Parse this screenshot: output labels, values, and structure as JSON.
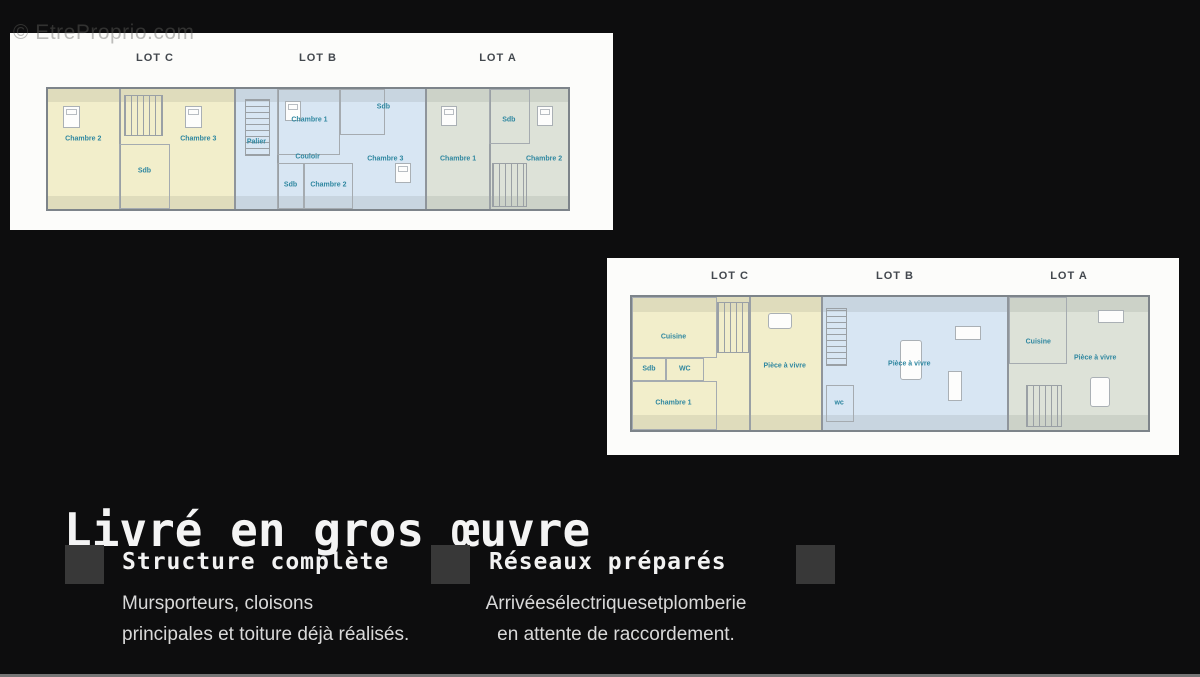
{
  "watermark": "© EtreProprio.com",
  "plans": [
    {
      "name": "floor-plan-upper",
      "lots": [
        {
          "name": "LOT C",
          "rooms": [
            "Chambre 2",
            "Sdb",
            "Chambre 3"
          ]
        },
        {
          "name": "LOT B",
          "rooms": [
            "Palier",
            "Chambre 1",
            "Sdb",
            "Couloir",
            "Sdb",
            "Chambre 2",
            "Chambre 3"
          ]
        },
        {
          "name": "LOT A",
          "rooms": [
            "Chambre 1",
            "Sdb",
            "Chambre 2"
          ]
        }
      ]
    },
    {
      "name": "floor-plan-ground",
      "lots": [
        {
          "name": "LOT C",
          "rooms": [
            "Cuisine",
            "Sdb",
            "WC",
            "Chambre 1",
            "Pièce à vivre"
          ]
        },
        {
          "name": "LOT B",
          "rooms": [
            "wc",
            "Pièce à vivre"
          ]
        },
        {
          "name": "LOT A",
          "rooms": [
            "Cuisine",
            "Pièce à vivre"
          ]
        }
      ]
    }
  ],
  "heading": "Livré en gros œuvre",
  "features": [
    {
      "title": "Structure complète",
      "lines": [
        "Mursporteurs, cloisons",
        "principales et toiture déjà réalisés."
      ]
    },
    {
      "title": "Réseaux préparés",
      "lines": [
        "Arrivéesélectriquesetplomberie",
        "en attente de raccordement."
      ]
    }
  ],
  "colors": {
    "background": "#0d0d0e",
    "lot_c_fill": "#f2eecb",
    "lot_b_fill": "#d8e6f3",
    "lot_a_fill": "#dde2d8",
    "room_label": "#2f87a0",
    "heading_text": "#f4f4f4",
    "body_text": "#d9d9d9",
    "bullet_square": "#383838"
  }
}
